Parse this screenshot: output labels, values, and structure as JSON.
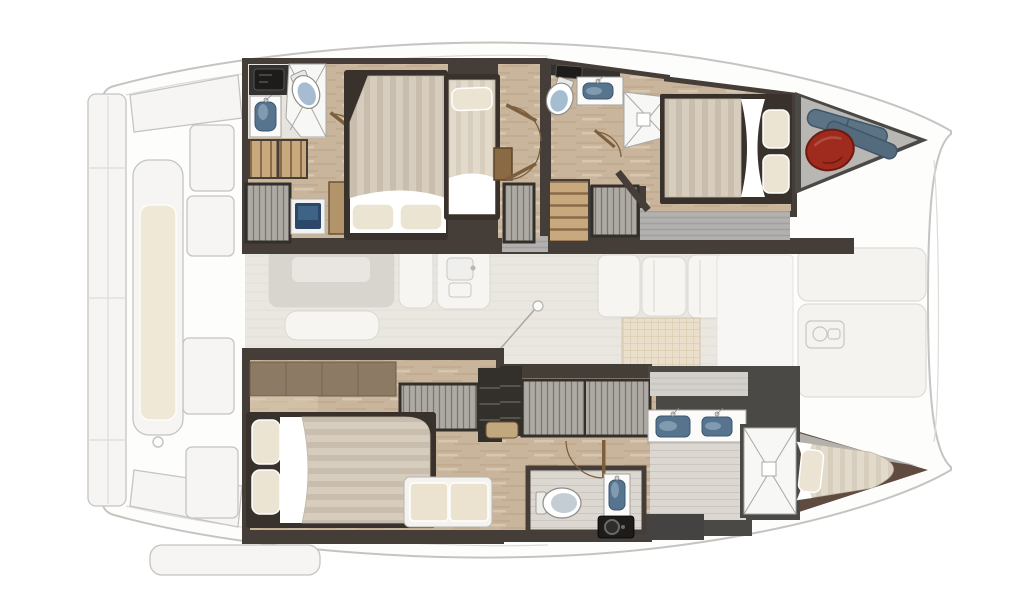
{
  "image_type": "catamaran-deck-floor-plan",
  "palette": {
    "ghost_line": "#c6c4c1",
    "ghost_inner": "#dedcd8",
    "hull_fill": "#fdfdfc",
    "panel_fill": "#f6f5f3",
    "cushion": "#efe8d6",
    "salon_floor": "#eae7e1",
    "salon_floor_line": "#dfdbd3",
    "salon_table": "#d8d4ce",
    "salon_table_top": "#e9e6e1",
    "salon_white": "#f6f5f2",
    "salon_stroke": "#dbd8d3",
    "grid_bg": "#e9dfca",
    "grid_line": "#d7c5a8",
    "wall_dark": "#453e38",
    "wall_gray": "#4b4946",
    "berth_wall": "#5f4b40",
    "door_brown": "#7d5f3d",
    "floor_wood": "#c8b59c",
    "floor_wood_line": "#b29a7c",
    "floor_wood_light": "#dbccb3",
    "floor_pale": "#dcd8d1",
    "floor_pale_line": "#cbc7c0",
    "deck_gray": "#b3b1ae",
    "deck_gray_line": "#a2a09d",
    "mattress": "#d7cdbf",
    "mattress_stripe": "#c9beae",
    "mattress_pale": "#e2dbcb",
    "mattress_pale_stripe": "#d7cebd",
    "pillow": "#ece4d3",
    "sheet": "#ffffff",
    "bed_frame": "#39322c",
    "mattress_edge": "#c1b6a5",
    "rib_bg": "#aeaaa3",
    "rib_line": "#7b7770",
    "step_wood": "#c8a87d",
    "step_line": "#8a6b49",
    "tile": "#f7f7f5",
    "tile_line": "#a9a8a5",
    "toilet_body": "#ffffff",
    "toilet_lid": "#a6bdd1",
    "toilet_lid_gray": "#c4cdd3",
    "fixture_stroke": "#8d8d8b",
    "counter_white": "#fbfbfa",
    "counter_stroke": "#a3a2a0",
    "sink_blue": "#57748e",
    "sink_stroke": "#3e5670",
    "sink_hi": "#a9c0d2",
    "counter_dark": "#343230",
    "device_black": "#1d1c1b",
    "device_line": "#555350",
    "screen_blue": "#2b4868",
    "screen_hi": "#486d94",
    "fender_red": "#9e2b1d",
    "fender_red_dk": "#701a0e",
    "fender_blue": "#5b7384",
    "fender_blue2": "#546b7d",
    "fender_blue_dk": "#41566a",
    "shelf_wood": "#8c7a64",
    "shelf_wood_line": "#6d5c47",
    "bench_cream": "#ebe2cf",
    "bench_white": "#f5f3ef",
    "cab_dark": "#332f2b",
    "cab_line": "#6b675f",
    "nightstand": "#b2946a",
    "wood_step": "#c2a87e",
    "wood_cab": "#8a6a44"
  },
  "plan": {
    "vessel": "catamaran",
    "view": "top-down interior deck plan",
    "port_hull": {
      "aft_bathroom": [
        "vanity-cabinet",
        "sink",
        "toilet",
        "shower-wet-room",
        "door"
      ],
      "aft_cabin": [
        "island-double-bed",
        "two-pillows",
        "entry-steps",
        "hanging-wardrobe",
        "vanity-screen",
        "nightstand"
      ],
      "companionway": [
        "single-berth",
        "pillow",
        "locker-cabinet",
        "two-doors",
        "ribbed-locker"
      ],
      "forward_bathroom": [
        "dark-counter",
        "toilet",
        "sink",
        "corner-shower",
        "door"
      ],
      "forward_stairs": [
        "steps",
        "hanging-wardrobe"
      ],
      "forward_cabin": [
        "double-bed",
        "two-pillows"
      ],
      "bow_locker": [
        "red-fender",
        "blue-fender",
        "blue-fender"
      ]
    },
    "starboard_hull": {
      "aft_cabin": [
        "island-double-bed",
        "two-pillows",
        "headboard-shelf",
        "hanging-wardrobe",
        "shelf-unit",
        "bench-seat"
      ],
      "midship": [
        "wood-step",
        "shelf-unit",
        "large-hanging-wardrobe",
        "corridor"
      ],
      "toilet_room": [
        "toilet",
        "sink",
        "washer",
        "door"
      ],
      "forward_bathroom": [
        "double-sink-vanity",
        "shower"
      ],
      "bow_berth": [
        "single-berth",
        "pillow"
      ]
    },
    "main_deck_ghost": {
      "aft_cockpit": [
        "transom-platform",
        "chaise-lounge",
        "deck-panels",
        "deck-hatch-rings"
      ],
      "salon": [
        "dining-table",
        "bench-sofa",
        "galley-island",
        "galley-sink",
        "cabinet-row",
        "deck-grid-pad",
        "mast-step-ball",
        "rigging-line"
      ],
      "foredeck": [
        "sun-pad",
        "sun-pad",
        "deck-hatch"
      ]
    }
  }
}
